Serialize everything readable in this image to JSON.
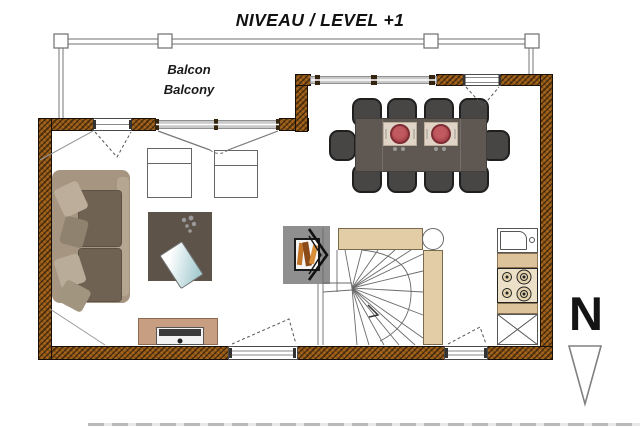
{
  "title": "NIVEAU / LEVEL +1",
  "labels": {
    "balcony_fr": "Balcon",
    "balcony_en": "Balcony",
    "north": "N"
  },
  "colors": {
    "wall_hatch": "#a5651e",
    "sofa": "#a69681",
    "sofa_cushion": "#6f6252",
    "dining_table": "#5f5751",
    "chair": "#474645",
    "plate": "#a8434a",
    "placemat": "#dfd4c5",
    "counter": "#dcc39c",
    "stair_wall": "#e3cda6",
    "tv_stand": "#c79e81",
    "coffee_table": "#5d5349",
    "fireplace_pad": "#8f8f8f",
    "log_orange": "#c3762a"
  }
}
